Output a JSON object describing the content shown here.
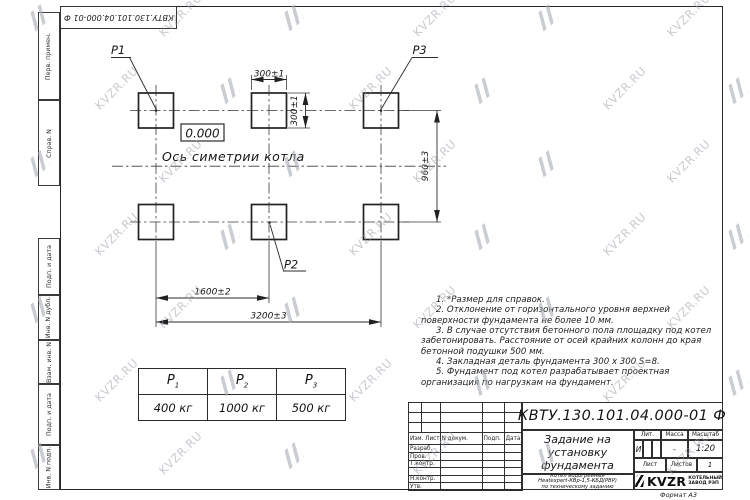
{
  "sheet": {
    "rotated_doc_number": "КВТУ.130.101.04.000-01 Ф",
    "format_label": "Формат А3",
    "margin_labels": [
      "Перв. примен.",
      "Справ. N",
      "Подп. и дата",
      "Инв. N дубл.",
      "Взам. инв. N",
      "Подп. и дата",
      "Инв. N подл."
    ]
  },
  "watermark": {
    "text": "KVZR.RU"
  },
  "drawing": {
    "pad_label_1": "P1",
    "pad_label_2": "P2",
    "pad_label_3": "P3",
    "elevation": "0.000",
    "axis_label": "Ось симетрии котла",
    "dim_pad_width": "300±1",
    "dim_pad_height": "300±1",
    "dim_row_spacing": "960±3",
    "dim_col_spacing": "1600±2",
    "dim_total_span": "3200±3"
  },
  "load_table": {
    "headers": [
      {
        "base": "P",
        "sub": "1"
      },
      {
        "base": "P",
        "sub": "2"
      },
      {
        "base": "P",
        "sub": "3"
      }
    ],
    "values": [
      "400 кг",
      "1000 кг",
      "500 кг"
    ]
  },
  "notes": [
    "1. *Размер для справок.",
    "2. Отклонение от горизонтального уровня верхней поверхности фундамента не более 10 мм.",
    "3. В случае отсутствия бетонного пола площадку под котел забетонировать. Расстояние от осей крайних колонн до края бетонной подушки 500 мм.",
    "4. Закладная деталь фундамента 300 x 300 S=8.",
    "5. Фундамент под котел разрабатывает проектная организация по нагрузкам на фундамент."
  ],
  "title_block": {
    "doc_number": "КВТУ.130.101.04.000-01 Ф",
    "title_line_1": "Задание на",
    "title_line_2": "установку",
    "title_line_3": "фундамента",
    "product_line_1": "Котел водогрейный",
    "product_line_2": "Heatexpert-КВр-1,5-КБД(РВР)",
    "product_line_3": "по техническому заданию",
    "col_izm_list": "Изм. Лист",
    "col_doc": "N докум.",
    "col_podp": "Подп.",
    "col_data": "Дата",
    "row_razrab": "Разраб.",
    "row_prov": "Пров.",
    "row_tkontr": "Т.контр.",
    "row_nkontr": "Н.контр.",
    "row_utv": "Утв.",
    "lit_label": "Лит.",
    "mass_label": "Масса",
    "scale_label": "Масштаб",
    "lit_value": "И",
    "mass_value": "-",
    "scale_value": "1:20",
    "sheet_label": "Лист",
    "sheets_label": "Листов",
    "sheets_value": "1",
    "logo_text": "KVZR",
    "logo_caption_line_1": "КОТЕЛЬНЫЙ",
    "logo_caption_line_2": "ЗАВОД РЭП"
  }
}
